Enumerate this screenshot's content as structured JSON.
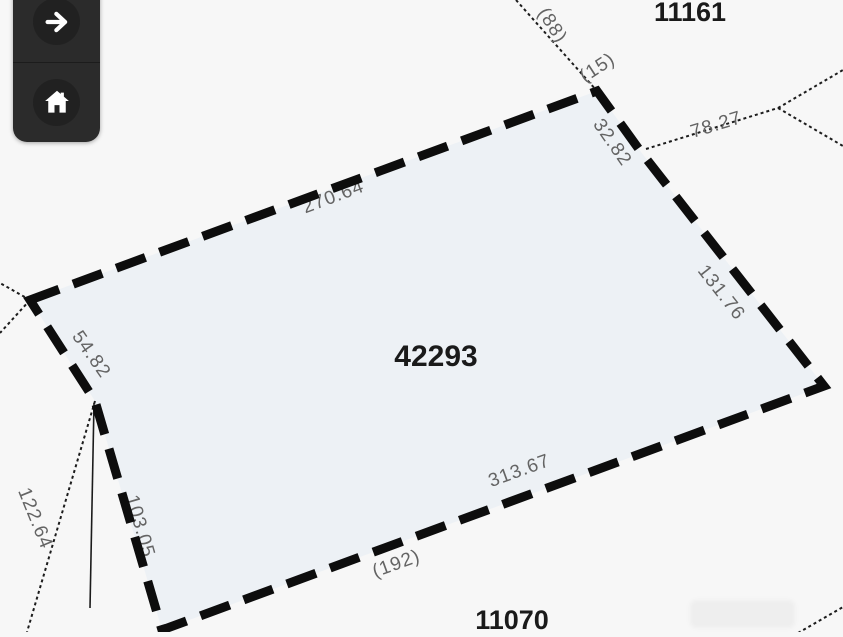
{
  "toolbar": {
    "forward_button": {
      "icon": "arrow-right-icon"
    },
    "home_button": {
      "icon": "home-icon"
    }
  },
  "map": {
    "selected_parcel": {
      "number": "42293",
      "dimensions": {
        "top": "270.64",
        "top_right": "32.82",
        "right": "131.76",
        "bottom": "313.67",
        "lower_left": "103.05",
        "upper_left": "54.82"
      }
    },
    "adjacent_parcels": {
      "top": "11161",
      "bottom": "11070"
    },
    "reference_labels": {
      "r15": "(15)",
      "r88": "(88)",
      "r192": "(192)"
    },
    "road_dimension": "78.27",
    "adjacent_dimension": "122.64"
  },
  "colors": {
    "background": "#f7f7f7",
    "parcel_fill": "#edf1f5",
    "boundary_line": "#0d0d0d",
    "thin_line": "#1c1c1c",
    "dimension_text": "#646464",
    "parcel_number_text": "#1a1a1a",
    "toolbar_background": "#2b2b2b",
    "toolbar_icon": "#ffffff"
  }
}
